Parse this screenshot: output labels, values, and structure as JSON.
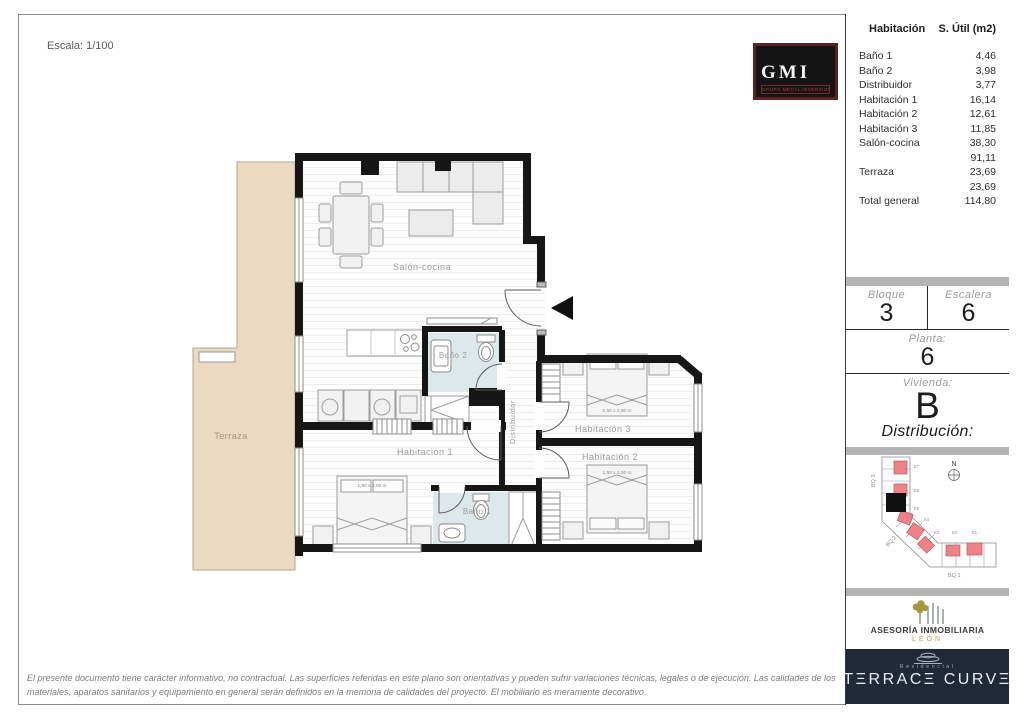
{
  "page": {
    "scale_label": "Escala: 1/100",
    "disclaimer_line1": "El presente documento tiene carácter informativo, no contractual. Las superficies referidas en este plano son orientativas y pueden sufrir variaciones técnicas, legales o de ejecución. Las calidades de los",
    "disclaimer_line2": "materiales, aparatos sanitarios y equipamiento en general serán definidos en la memoria de calidades del proyecto. El mobiliario es meramente decorativo."
  },
  "gmi_logo": {
    "name": "GMI",
    "subtitle": "GRUPO MECAL INVERSIONES"
  },
  "area_table": {
    "col_room": "Habitación",
    "col_area": "S. Útil (m2)",
    "rows": [
      {
        "room": "Baño 1",
        "area": "4,46"
      },
      {
        "room": "Baño 2",
        "area": "3,98"
      },
      {
        "room": "Distribuidor",
        "area": "3,77"
      },
      {
        "room": "Habitación 1",
        "area": "16,14"
      },
      {
        "room": "Habitación 2",
        "area": "12,61"
      },
      {
        "room": "Habitación 3",
        "area": "11,85"
      },
      {
        "room": "Salón-cocina",
        "area": "38,30"
      },
      {
        "room": "",
        "area": "91,11"
      },
      {
        "room": "Terraza",
        "area": "23,69"
      },
      {
        "room": "",
        "area": "23,69"
      },
      {
        "room": "Total general",
        "area": "114,80"
      }
    ]
  },
  "unit_info": {
    "bloque_label": "Bloque",
    "bloque_value": "3",
    "escalera_label": "Escalera",
    "escalera_value": "6",
    "planta_label": "Planta:",
    "planta_value": "6",
    "vivienda_label": "Vivienda:",
    "vivienda_value": "B",
    "distribucion_label": "Distribución:"
  },
  "site_map": {
    "north_label": "N",
    "bq3_label": "BQ 3",
    "bq2_label": "BQ 2",
    "bq1_label": "BQ 1",
    "stair_labels": [
      "E7",
      "E6",
      "E5",
      "E4",
      "E3",
      "E2",
      "E1"
    ]
  },
  "agency_logo": {
    "line1": "ASESORÍA INMOBILIARIA",
    "line2": "LEÓN"
  },
  "brand_logo": {
    "residencial": "Residencial",
    "name": "TΞRRACΞ CURVΞ"
  },
  "floor_plan": {
    "labels": {
      "salon": "Salón-cocina",
      "bano2": "Baño 2",
      "bano1": "Baño 1",
      "hab1": "Habitación 1",
      "hab2": "Habitación 2",
      "hab3": "Habitación 3",
      "distribuidor": "Distribuidor",
      "terraza": "Terraza"
    },
    "bed_dim": "1,50 x 2,00 m"
  },
  "colors": {
    "bar_gray": "#b4b4b4",
    "navy": "#202938",
    "gold": "#b89b51",
    "terrace": "#ecd9c1",
    "bath": "#dde8ea",
    "unit_red": "#ef8287",
    "wall": "#161616"
  }
}
